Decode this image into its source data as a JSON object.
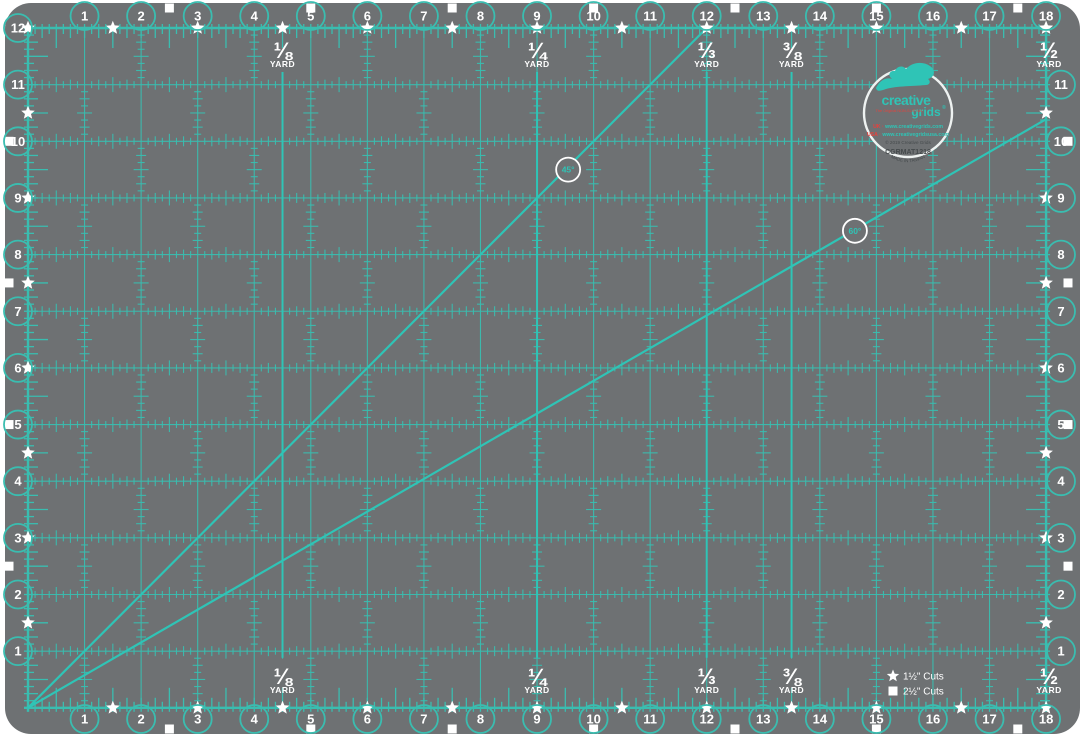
{
  "product": {
    "type": "rotary-cutting-mat",
    "grid_width_inches": 18,
    "grid_height_inches": 12
  },
  "colors": {
    "mat_gray": "#6e7173",
    "grid_teal": "#3abdb0",
    "bright_teal": "#2fc4b6",
    "white": "#ffffff",
    "logo_red": "#e8413c",
    "logo_dark": "#454a4c"
  },
  "numbers": {
    "top": [
      "1",
      "2",
      "3",
      "4",
      "5",
      "6",
      "7",
      "8",
      "9",
      "10",
      "11",
      "12",
      "13",
      "14",
      "15",
      "16",
      "17",
      "18"
    ],
    "bottom": [
      "1",
      "2",
      "3",
      "4",
      "5",
      "6",
      "7",
      "8",
      "9",
      "10",
      "11",
      "12",
      "13",
      "14",
      "15",
      "16",
      "17",
      "18"
    ],
    "left": [
      "12",
      "11",
      "10",
      "9",
      "8",
      "7",
      "6",
      "5",
      "4",
      "3",
      "2",
      "1"
    ],
    "right": [
      "11",
      "10",
      "9",
      "8",
      "7",
      "6",
      "5",
      "4",
      "3",
      "2",
      "1"
    ]
  },
  "yard_markers": [
    {
      "fraction": "⅛",
      "unit": "YARD",
      "inches": 4.5
    },
    {
      "fraction": "¼",
      "unit": "YARD",
      "inches": 9
    },
    {
      "fraction": "⅓",
      "unit": "YARD",
      "inches": 12
    },
    {
      "fraction": "⅜",
      "unit": "YARD",
      "inches": 13.5
    },
    {
      "fraction": "½",
      "unit": "YARD",
      "inches": 18
    }
  ],
  "angle_lines": [
    {
      "label": "45°",
      "end_x_inches": 12,
      "end_y_inches": 12,
      "badge_x_inches": 9.55,
      "badge_y_inches": 9.5
    },
    {
      "label": "60°",
      "end_x_inches": 18,
      "end_y_inches": 10.39,
      "badge_x_inches": 14.62,
      "badge_y_inches": 8.42
    }
  ],
  "markers": {
    "star_interval_inches": 1.5,
    "square_interval_inches": 2.5
  },
  "legend": [
    {
      "symbol": "star",
      "label": "1½\" Cuts"
    },
    {
      "symbol": "square",
      "label": "2½\" Cuts"
    }
  ],
  "logo": {
    "brand_top": "creative",
    "brand_bottom": "grids",
    "registered": "®",
    "tagline": "The Original NON-SLIP tool",
    "uk_prefix": "UK · ",
    "uk_url": "www.creativegrids.com",
    "usa_prefix": "USA · ",
    "usa_url": "www.creativegridsusa.com",
    "copyright": "© 2019 Creative Grids",
    "sku": "CGRMAT1218",
    "made_in": "MADE IN TAIWAN"
  }
}
